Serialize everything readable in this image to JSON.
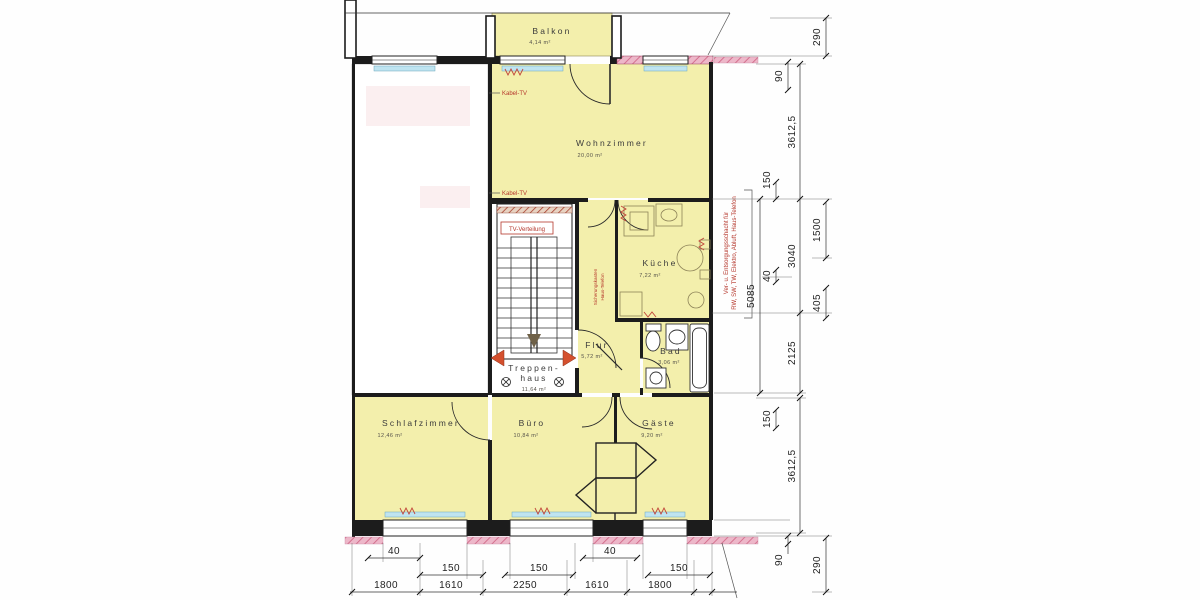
{
  "rooms": {
    "balkon": {
      "name": "Balkon",
      "area": "4,14 m²"
    },
    "wohnzimmer": {
      "name": "Wohnzimmer",
      "area": "20,00 m²"
    },
    "kueche": {
      "name": "Küche",
      "area": "7,22 m²"
    },
    "flur": {
      "name": "Flur",
      "area": "5,72 m²"
    },
    "bad": {
      "name": "Bad",
      "area": "3,06 m²"
    },
    "treppenhaus": {
      "name1": "Treppen-",
      "name2": "haus",
      "area": "11,64 m²"
    },
    "schlafzimmer": {
      "name": "Schlafzimmer",
      "area": "12,46 m²"
    },
    "buero": {
      "name": "Büro",
      "area": "10,84 m²"
    },
    "gaeste": {
      "name": "Gäste",
      "area": "9,20 m²"
    }
  },
  "annotations": {
    "kabel_tv": "Kabel-TV",
    "tv_verteilung": "TV-Verteilung",
    "schacht": {
      "line1": "Ver- u. Entsorgungsschacht für",
      "line2": "RW, SW, TW, Elektro, Abluft, Haus-Telefon"
    },
    "corridor": {
      "line1": "Sicherungskasten",
      "line2": "Haus-Telefon"
    }
  },
  "dims": {
    "right": [
      "290",
      "90",
      "3612,5",
      "150",
      "5085",
      "1500",
      "3040",
      "40",
      "405",
      "2125",
      "150",
      "3612,5",
      "90",
      "290"
    ],
    "bottom_40": [
      "40",
      "40"
    ],
    "bottom_150": [
      "150",
      "150",
      "150"
    ],
    "bottom_large": [
      "1800",
      "1610",
      "2250",
      "1610",
      "1800"
    ]
  },
  "colors": {
    "room_fill": "#f3efac",
    "wall": "#1c1c1c",
    "window_sill": "#bfe4f0",
    "pink_wall": "#e39ab5",
    "red_annotation": "#b5372c",
    "stair_arrow": "#d4502e"
  }
}
